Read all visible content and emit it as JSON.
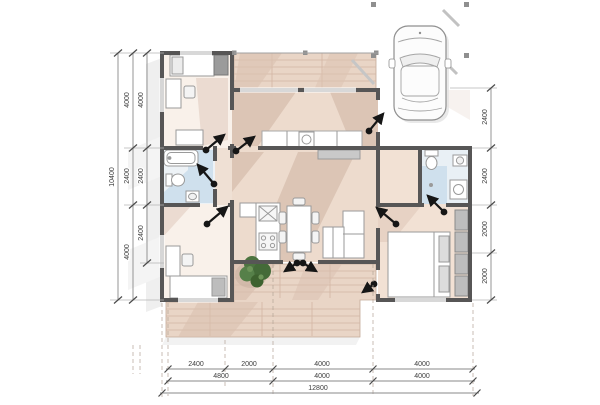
{
  "drawing": {
    "type": "floor-plan",
    "dimensions": {
      "left_overall": "10400",
      "left_col1": [
        "4000",
        "2400",
        "4000"
      ],
      "left_col2": [
        "4000",
        "2400",
        "2400"
      ],
      "right_col": [
        "2400",
        "2400",
        "2000",
        "2000"
      ],
      "bottom_row1": [
        "2400",
        "2000",
        "4000",
        "4000"
      ],
      "bottom_row2": [
        "4800",
        "4000",
        "4000"
      ],
      "bottom_total": "12800"
    },
    "objects": [
      "car",
      "carport",
      "terrace-deck",
      "bed",
      "bathtub",
      "toilet",
      "washbasin",
      "shower",
      "washing-machine",
      "kitchen-stove",
      "kitchen-sink",
      "dining-table",
      "sofa",
      "wardrobe",
      "desk",
      "plant",
      "door-swing",
      "window"
    ],
    "colors": {
      "wall": "#575656",
      "floor_light": "#f9f1ea",
      "floor_tan": "#eddbcd",
      "floor_shadow": "#d8c0b0",
      "deck": "#e9d5c6",
      "deck_plank": "#d2b5a3",
      "bath_blue": "#cfe0ed",
      "plant_green": "#4d7440",
      "dim_text": "#3c3c3c"
    }
  }
}
